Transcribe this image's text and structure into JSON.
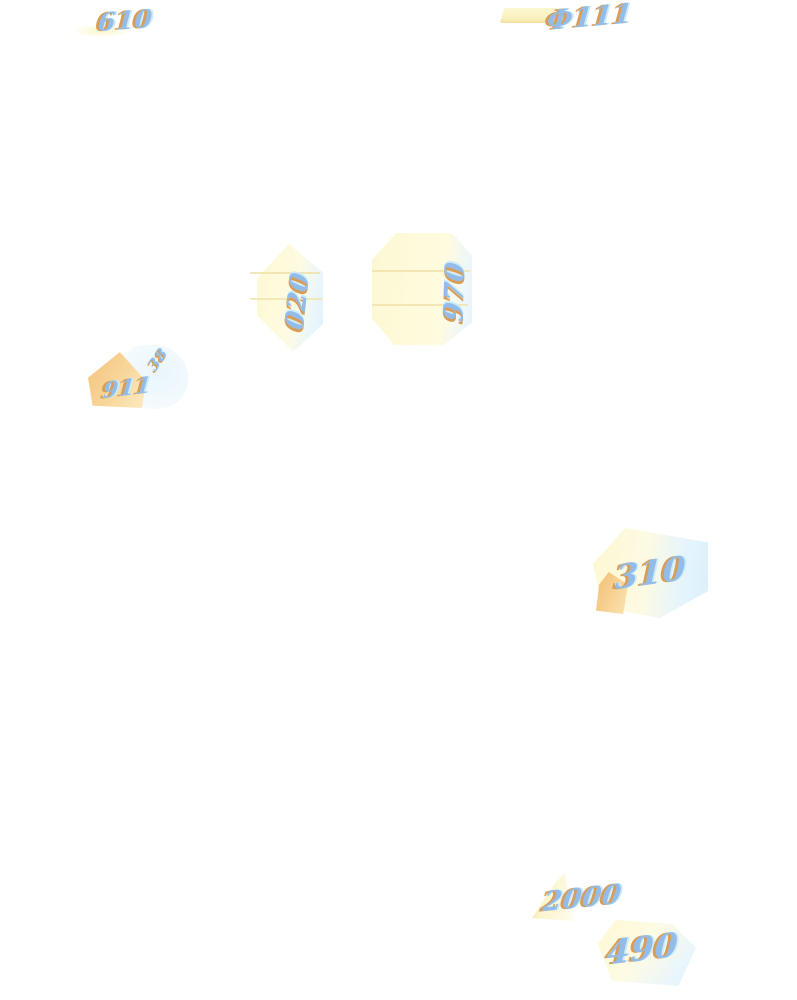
{
  "document": {
    "kind": "scanned archival page, mostly blank, with faint stamped numbers",
    "background_color": "#ffffff"
  },
  "palette": {
    "blob_yellow": "#fdf8d3",
    "blob_cyan": "#dff2fb",
    "streak_tan": "#f0e1a8",
    "ink_blue": "#93bde8",
    "ink_orange_fringe": "#d99d58",
    "ink_cyan_fringe": "#cdecfa",
    "wedge_orange": "#f4c17b"
  },
  "marks": {
    "top_left_number": "610",
    "top_right_number": "Ф111",
    "mid_left_number": "020",
    "mid_center_number": "970",
    "left_small_number": "38",
    "left_main_number": "911",
    "right_mid_number": "310",
    "bottom_center_number": "2000",
    "bottom_right_number": "490"
  }
}
